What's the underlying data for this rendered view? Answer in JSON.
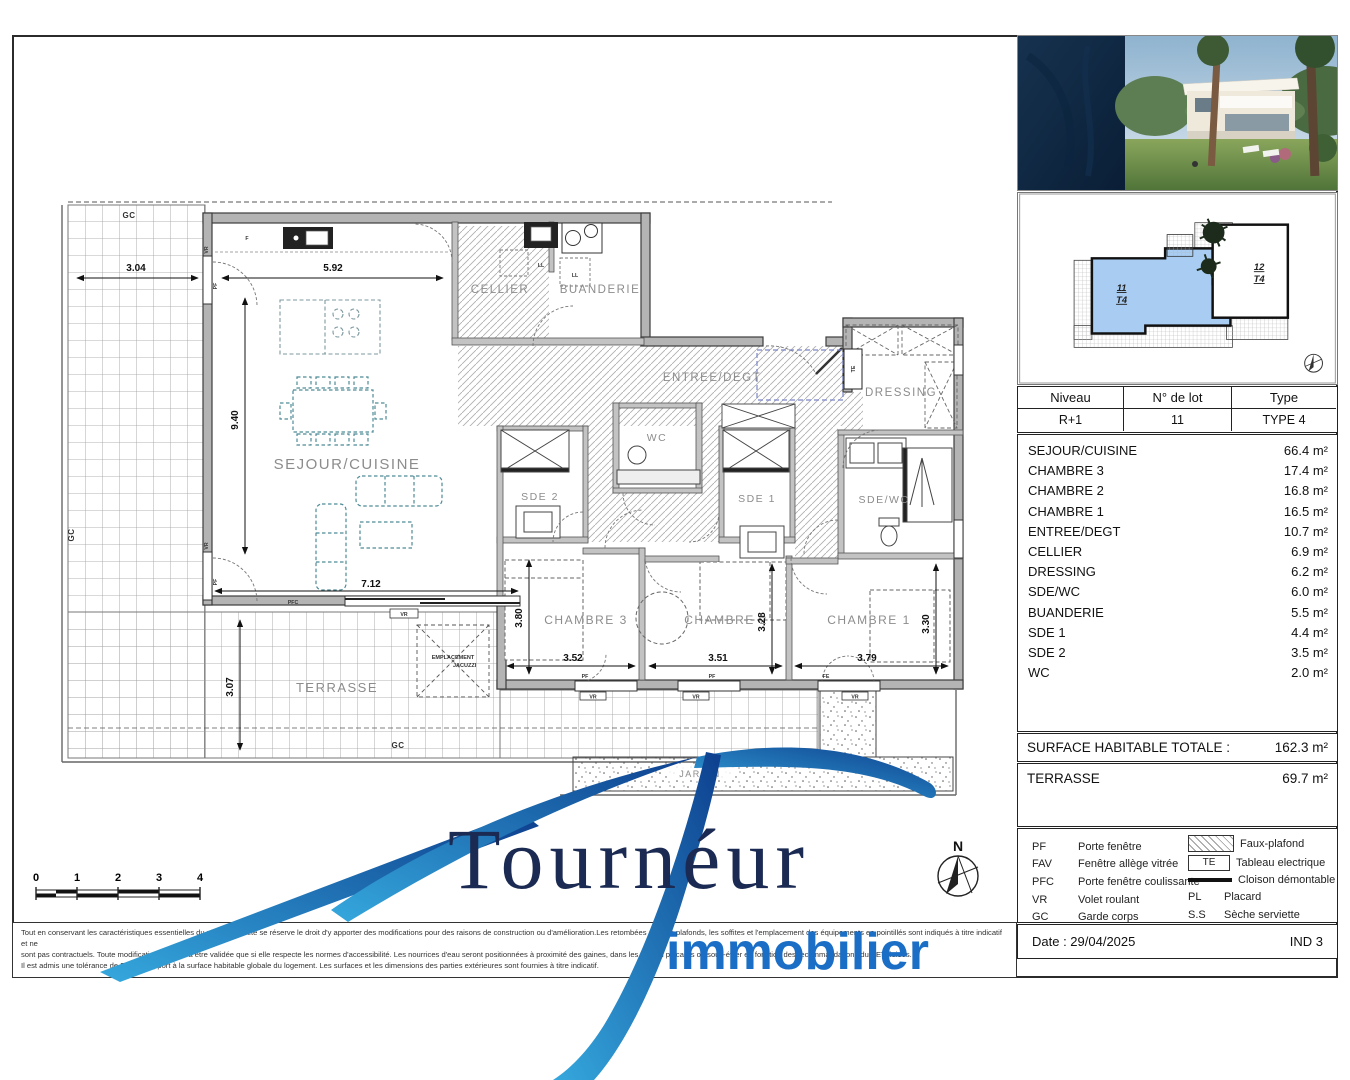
{
  "colors": {
    "accent_blue": "#1b6cc0",
    "logo_navy": "#1a2a52",
    "plan_furniture_teal": "#4d8b97",
    "keyplan_highlight": "#a9cdf2"
  },
  "lot_table": {
    "headers": [
      "Niveau",
      "N° de lot",
      "Type"
    ],
    "values": [
      "R+1",
      "11",
      "TYPE 4"
    ]
  },
  "rooms": [
    {
      "name": "SEJOUR/CUISINE",
      "area": "66.4 m²"
    },
    {
      "name": "CHAMBRE 3",
      "area": "17.4 m²"
    },
    {
      "name": "CHAMBRE 2",
      "area": "16.8 m²"
    },
    {
      "name": "CHAMBRE 1",
      "area": "16.5 m²"
    },
    {
      "name": "ENTREE/DEGT",
      "area": "10.7 m²"
    },
    {
      "name": "CELLIER",
      "area": "6.9 m²"
    },
    {
      "name": "DRESSING",
      "area": "6.2 m²"
    },
    {
      "name": "SDE/WC",
      "area": "6.0 m²"
    },
    {
      "name": "BUANDERIE",
      "area": "5.5 m²"
    },
    {
      "name": "SDE 1",
      "area": "4.4 m²"
    },
    {
      "name": "SDE 2",
      "area": "3.5 m²"
    },
    {
      "name": "WC",
      "area": "2.0 m²"
    }
  ],
  "totals": {
    "surface_label": "SURFACE HABITABLE TOTALE :",
    "surface_value": "162.3 m²",
    "terrace_label": "TERRASSE",
    "terrace_value": "69.7 m²"
  },
  "legend": {
    "abbrevs": [
      {
        "code": "PF",
        "label": "Porte fenêtre"
      },
      {
        "code": "FAV",
        "label": "Fenêtre allège vitrée"
      },
      {
        "code": "PFC",
        "label": "Porte fenêtre coulissante"
      },
      {
        "code": "VR",
        "label": "Volet roulant"
      },
      {
        "code": "GC",
        "label": "Garde corps"
      }
    ],
    "faux_plafond": "Faux-plafond",
    "te_code": "TE",
    "tableau": "Tableau electrique",
    "cloison": "Cloison démontable",
    "pl_code": "PL",
    "placard": "Placard",
    "ss_code": "S.S",
    "seche": "Sèche serviette"
  },
  "footer": {
    "date": "Date : 29/04/2025",
    "index": "IND 3",
    "disclaimer_lines": [
      "Tout en conservant les caractéristiques essentielles du plan, la société se réserve le droit d'y apporter des modifications pour des raisons de construction ou d'amélioration.Les retombées de faux-plafonds, les soffites et l'emplacement des équipements en pointillés sont indiqués à titre indicatif et ne",
      "sont pas contractuels. Toute modification ne pourra être validée que si elle respecte les normes d'accessibilité. Les nourrices d'eau seront positionnées à proximité des gaines, dans les WC ou placards ou sous-évier en fonction des recommandations du BET fluides.",
      "Il est admis une tolérance de 5% par rapport à la surface habitable globale du logement. Les surfaces et les dimensions des parties extérieures sont fournies à titre indicatif."
    ]
  },
  "logo": {
    "name": "Tournéur",
    "subtitle": "immobilier"
  },
  "keyplan": {
    "unit11_lot": "11",
    "unit11_type": "T4",
    "unit12_lot": "12",
    "unit12_type": "T4"
  },
  "scalebar": {
    "ticks": [
      "0",
      "1",
      "2",
      "3",
      "4"
    ]
  },
  "compass": {
    "north": "N"
  },
  "plan": {
    "labels": {
      "sejour": "SEJOUR/CUISINE",
      "cellier": "CELLIER",
      "buanderie": "BUANDERIE",
      "entree": "ENTREE/DEGT",
      "dressing": "DRESSING",
      "wc": "WC",
      "sde2": "SDE 2",
      "sde1": "SDE 1",
      "sdewc": "SDE/WC",
      "ch3": "CHAMBRE 3",
      "ch2": "CHAMBRE 2",
      "ch1": "CHAMBRE 1",
      "terrasse": "TERRASSE",
      "jardin": "JARDIN",
      "jacuzzi1": "EMPLACEMENT",
      "jacuzzi2": "JACUZZI"
    },
    "dims": {
      "w304": "3.04",
      "w592": "5.92",
      "h940": "9.40",
      "w712": "7.12",
      "h307": "3.07",
      "w352": "3.52",
      "w351": "3.51",
      "w379": "3.79",
      "h380": "3.80",
      "h328": "3.28",
      "h330": "3.30"
    },
    "marks": {
      "gc": "GC",
      "vr": "VR",
      "pf": "PF",
      "pfc": "PFC",
      "fe": "FE",
      "f": "F",
      "te": "TE",
      "ll": "LL"
    }
  }
}
